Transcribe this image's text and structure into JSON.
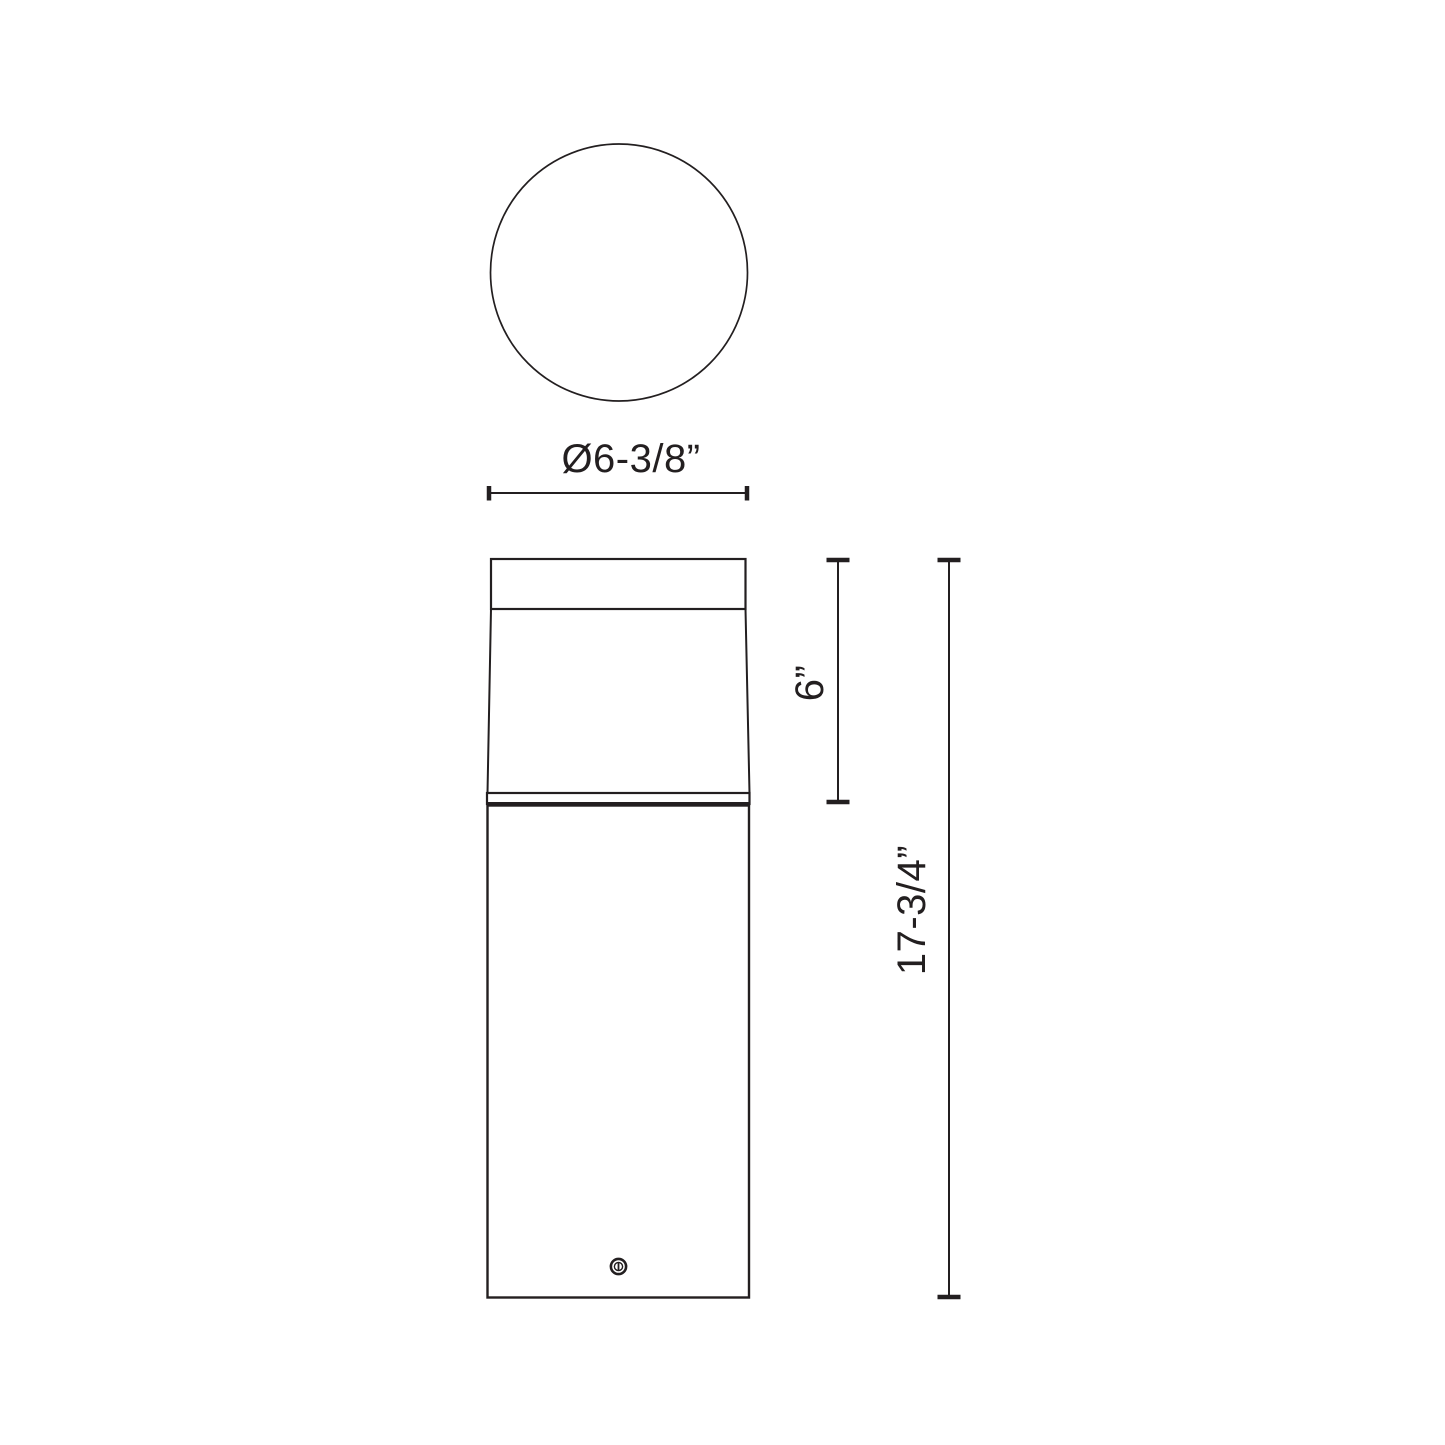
{
  "page": {
    "background": "#ffffff",
    "line_color": "#231f20"
  },
  "top_view": {
    "diameter_label": "Ø6-3/8”"
  },
  "side_view": {
    "head_height_label": "6”",
    "overall_height_label": "17-3/4”"
  }
}
